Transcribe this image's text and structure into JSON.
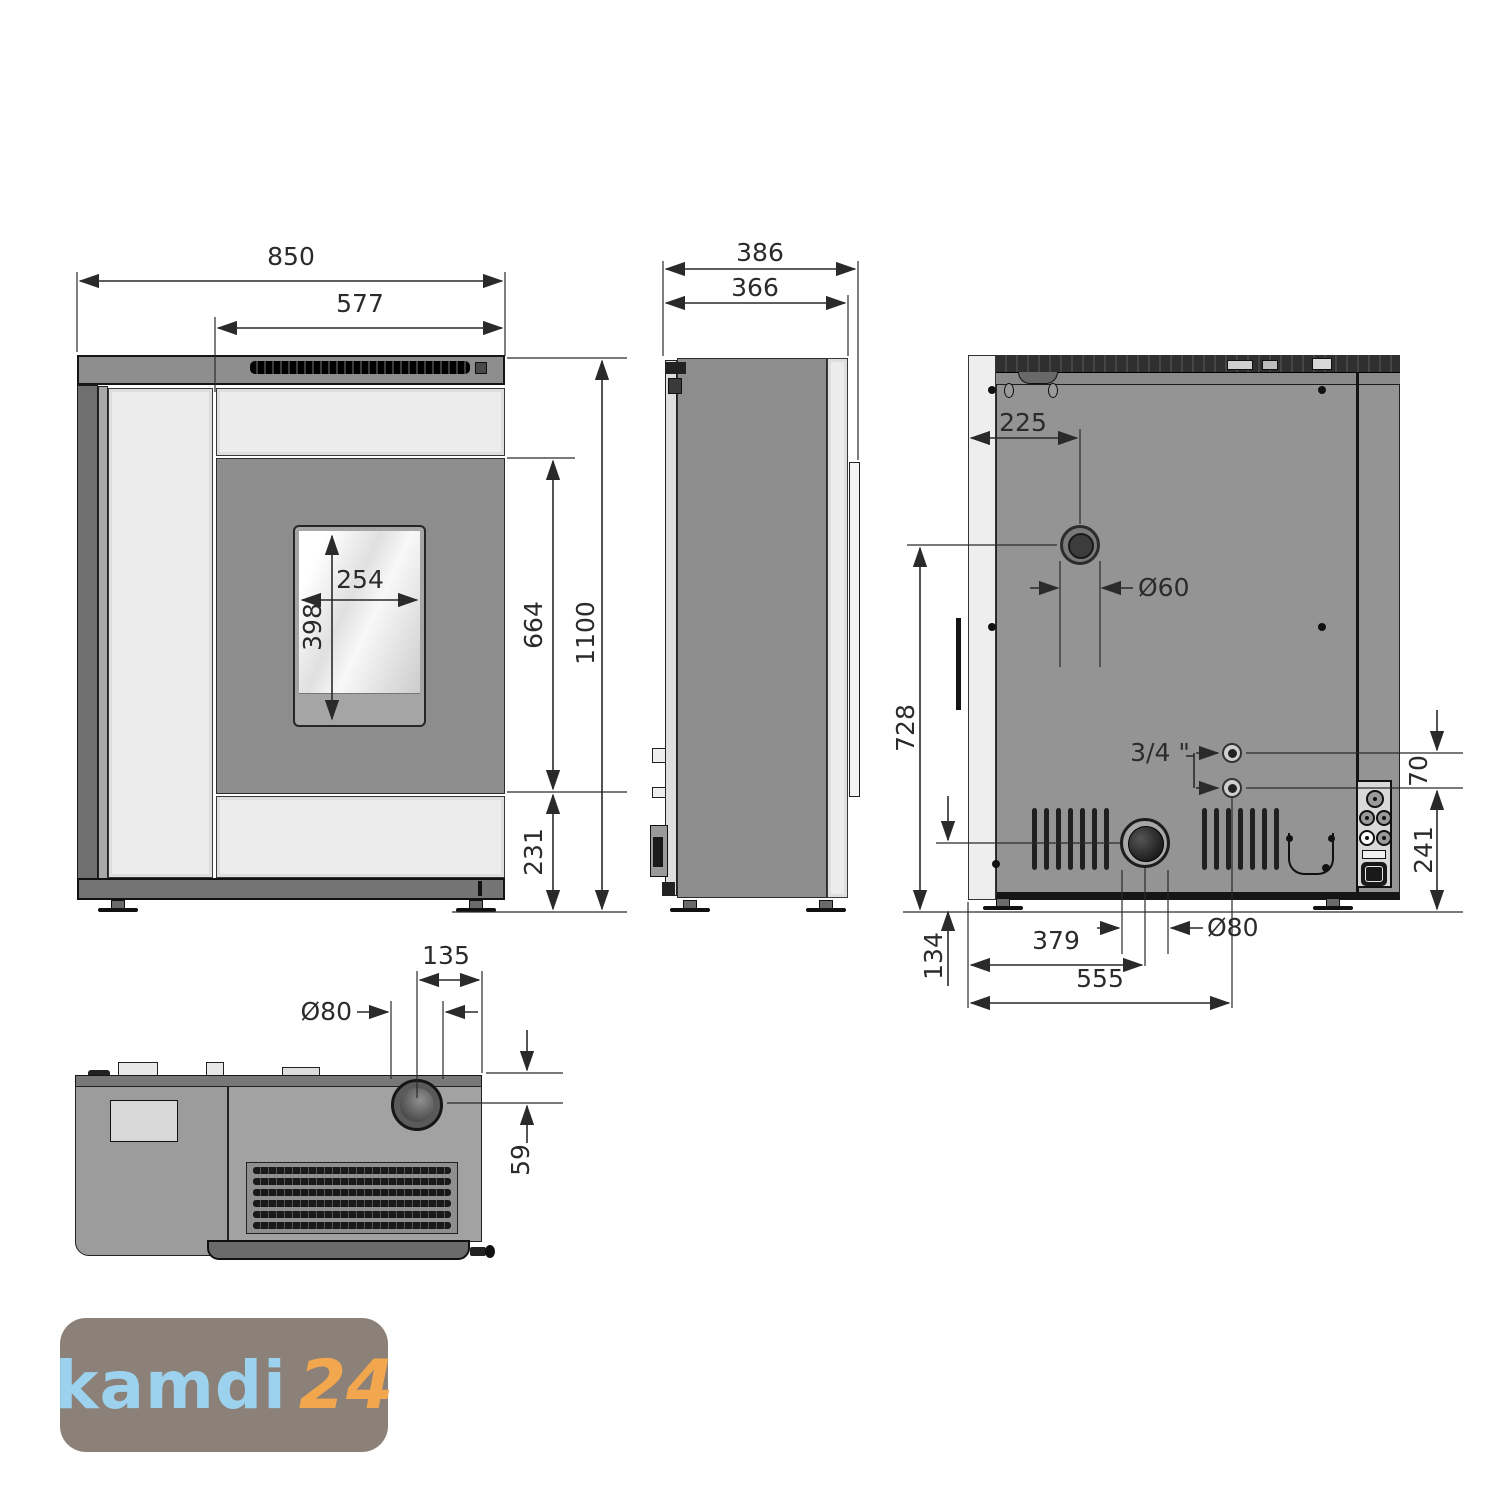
{
  "title": "Pellet stove dimensional drawing (front, side, rear, top views)",
  "views": {
    "front": {
      "dims": {
        "total_width": "850",
        "top_width": "577",
        "window_width": "254",
        "window_height": "398",
        "door_height": "664",
        "total_height": "1100",
        "base_height": "231"
      }
    },
    "side": {
      "dims": {
        "total_depth": "386",
        "body_depth": "366"
      }
    },
    "rear": {
      "dims": {
        "flue_top_offset": "225",
        "flue_top_diameter": "Ø60",
        "flue_center_height": "728",
        "pipe_thread": "3/4 \"",
        "pipe_spacing": "70",
        "connection_height": "241",
        "flue_bottom_height": "134",
        "flue_offset": "379",
        "pipe_offset": "555",
        "flue_diameter": "Ø80"
      }
    },
    "top": {
      "dims": {
        "flue_side_offset": "135",
        "flue_diameter": "Ø80",
        "flue_rear_offset": "59"
      }
    }
  },
  "logo": {
    "brand": "kamdi",
    "number": "24",
    "colors": {
      "background": "#8b8178",
      "brand": "#9cd2ee",
      "number": "#f2a74e"
    }
  }
}
